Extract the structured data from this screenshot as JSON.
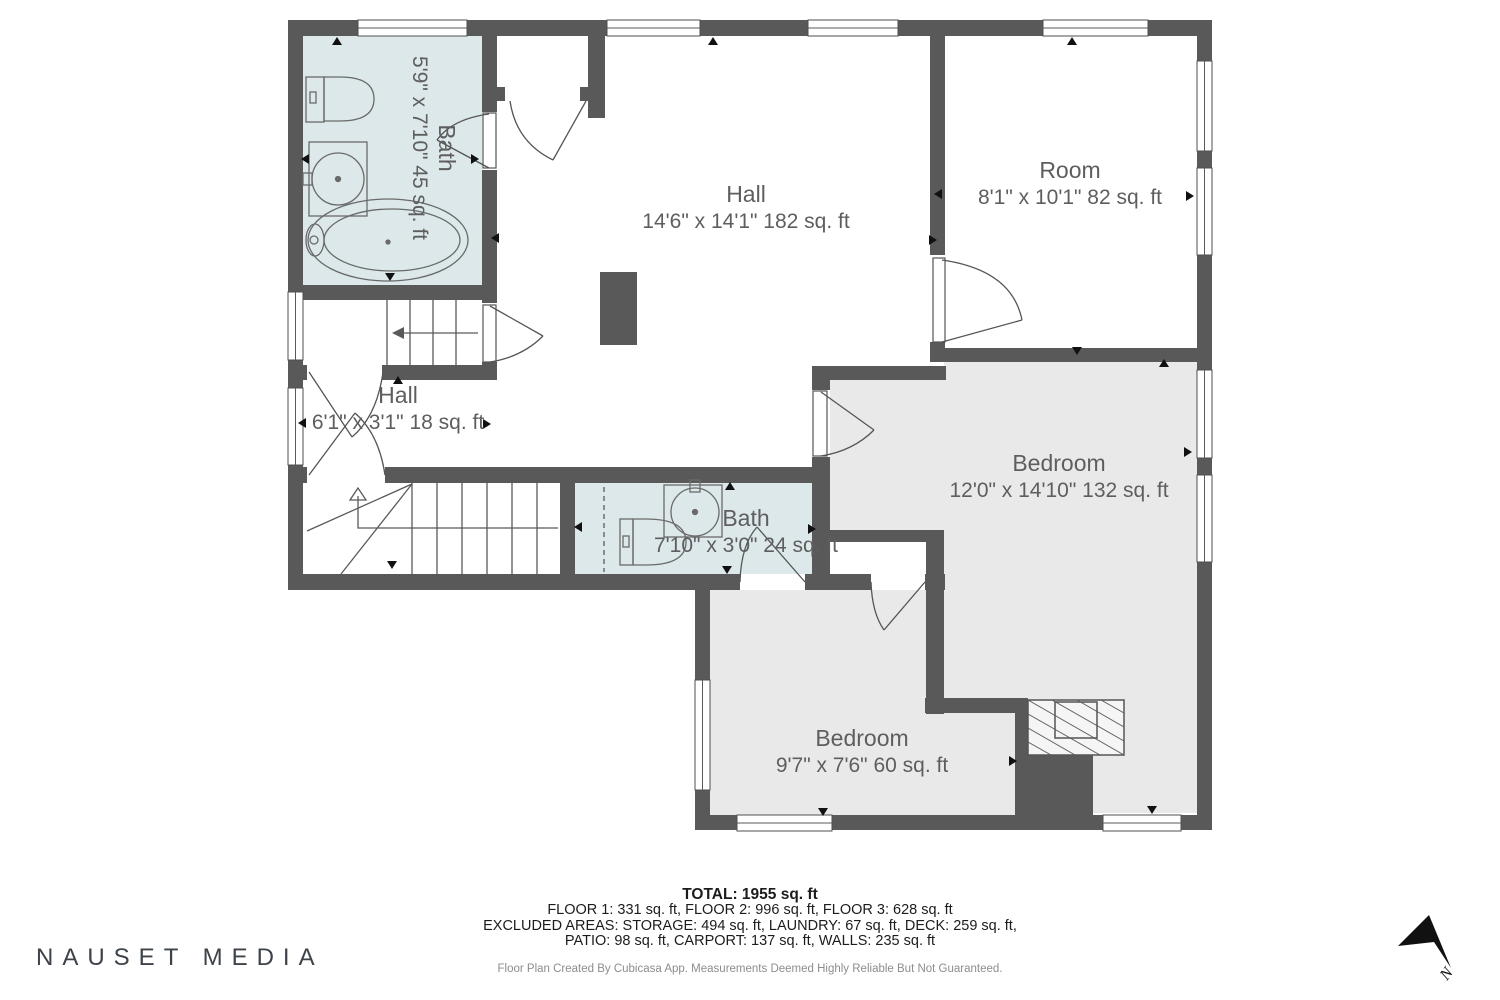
{
  "rooms": {
    "bath_upper": {
      "name": "Bath",
      "dims": "5'9\" x 7'10\" 45 sq. ft"
    },
    "hall_main": {
      "name": "Hall",
      "dims": "14'6\" x 14'1\" 182 sq. ft"
    },
    "room_upper": {
      "name": "Room",
      "dims": "8'1\" x 10'1\" 82 sq. ft"
    },
    "hall_small": {
      "name": "Hall",
      "dims": "6'1\" x 3'1\" 18 sq. ft"
    },
    "bath_middle": {
      "name": "Bath",
      "dims": "7'10\" x 3'0\" 24 sq. ft"
    },
    "bedroom_main": {
      "name": "Bedroom",
      "dims": "12'0\" x 14'10\" 132 sq. ft"
    },
    "bedroom_small": {
      "name": "Bedroom",
      "dims": "9'7\" x 7'6\" 60 sq. ft"
    }
  },
  "summary": {
    "total": "TOTAL: 1955 sq. ft",
    "line1": "FLOOR 1: 331 sq. ft, FLOOR 2: 996 sq. ft, FLOOR 3: 628 sq. ft",
    "line2": "EXCLUDED AREAS: STORAGE: 494 sq. ft, LAUNDRY: 67 sq. ft, DECK: 259 sq. ft,",
    "line3": "PATIO: 98 sq. ft, CARPORT: 137 sq. ft, WALLS: 235 sq. ft",
    "disclaimer": "Floor Plan Created By Cubicasa App. Measurements Deemed Highly Reliable But Not Guaranteed."
  },
  "branding": {
    "watermark": "NAUSET MEDIA"
  },
  "compass": {
    "label": "N"
  },
  "colors": {
    "wall": "#595959",
    "bath_floor": "#dce8ea",
    "bedroom_floor": "#e9e9e9",
    "fixture_line": "#5a5a5a",
    "label_text": "#5e5e5e"
  }
}
